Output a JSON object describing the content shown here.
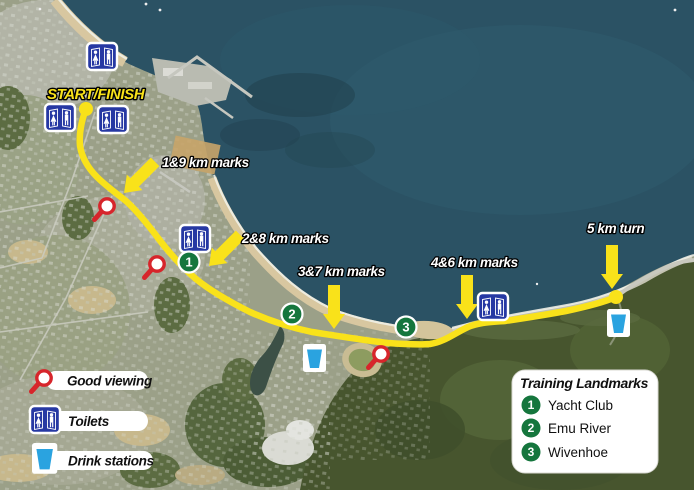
{
  "route": {
    "start_label": "START/FINISH",
    "km_labels": [
      {
        "text": "1&9 km marks"
      },
      {
        "text": "2&8 km marks"
      },
      {
        "text": "3&7 km marks"
      },
      {
        "text": "4&6 km marks"
      },
      {
        "text": "5 km turn"
      }
    ]
  },
  "markers": {
    "route_numbers": [
      "1",
      "2",
      "3"
    ]
  },
  "legend": {
    "items": [
      {
        "icon": "magnifier-icon",
        "label": "Good viewing"
      },
      {
        "icon": "toilets-icon",
        "label": "Toilets"
      },
      {
        "icon": "drink-station-icon",
        "label": "Drink stations"
      }
    ]
  },
  "landmarks": {
    "title": "Training Landmarks",
    "items": [
      {
        "number": "1",
        "label": "Yacht Club"
      },
      {
        "number": "2",
        "label": "Emu River"
      },
      {
        "number": "3",
        "label": "Wivenhoe"
      }
    ]
  },
  "colors": {
    "ocean": "#2b5264",
    "route_yellow": "#f9e21a",
    "marker_green": "#15763d",
    "toilet_blue": "#2638a3",
    "drink_blue": "#2aa3e0",
    "viewing_red": "#d7252b",
    "sand": "#d8c7a0",
    "forest": "#47552e"
  }
}
